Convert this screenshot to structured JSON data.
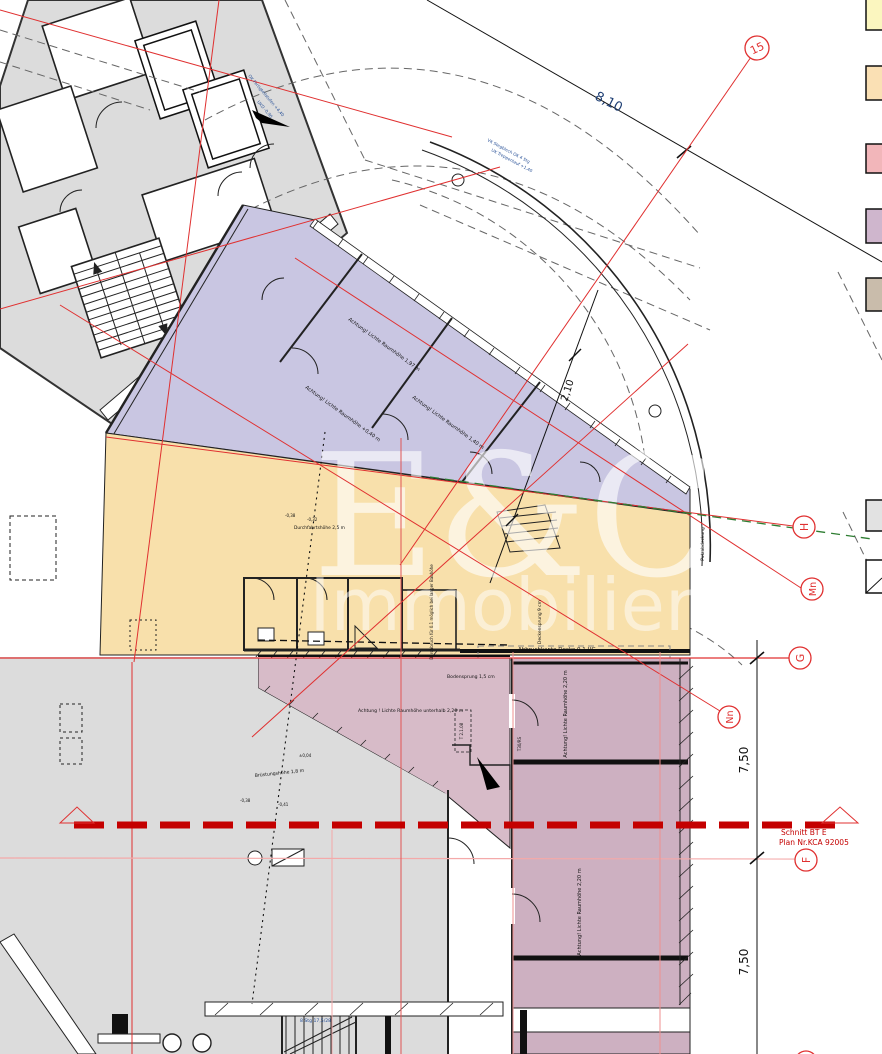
{
  "plan": {
    "watermark": {
      "line1": "E&C",
      "line2": "Immobilien"
    },
    "grid_bubbles": {
      "b15": "15",
      "h": "H",
      "mn": "Mn",
      "g": "G",
      "nn": "Nn",
      "f": "F"
    },
    "dimensions": {
      "d810": "8,10",
      "d210": "2,10",
      "d750a": "7,50",
      "d750b": "7,50"
    },
    "section_marker": {
      "line1": "Schnitt BT E",
      "line2": "Plan Nr.KCA 92005"
    },
    "annotations": {
      "abbruchkante": "Abbruchkante Decke 0.1 UG",
      "lichte_197": "Achtung! Lichte Raumhöhe 1,97 m",
      "lichte_040": "Achtung! Lichte Raumhöhe +0,40 m",
      "lichte_140": "Achtung! Lichte Raumhöhe 1,40 m",
      "lichte_220": "Achtung! Lichte Raumhöhe 2,20 m",
      "lichte_unterhalb": "Achtung ! Lichte Raumhöhe unterhalb 2,20 m",
      "bodensprung": "Bodensprung 1,5 cm",
      "deckensprung": "Deckensprung 9 cm",
      "durchbruch": "Durchbruch für 0.1 möglich bei langer Bauhöhe",
      "durchfahrt": "Durchfahrtshöhe 2,5 m",
      "bruestung": "Brüstungshöhe 1,8 m",
      "putzabdeckung": "Putzabdeckung",
      "treppe_stg": "8 Stg 17,5/28",
      "vk_stegblech": "VK Stegblech OK 4 Stg",
      "uk_treppenlauf": "UK Treppenlauf +1,40",
      "ok_fertigteil": "OK Fertigteilstufen +4,40",
      "ukd": "UKD -0,90",
      "t30rs": "T30/RS",
      "t2108": "T 2.1.08",
      "mark_038": "-0,38",
      "mark_032": "-0,32",
      "mark_041": "-0,41",
      "mark_004": "±0,04"
    },
    "colors": {
      "gray_area": "#dcdcdc",
      "lavender_area": "#c9c6e2",
      "yellow_area": "#f8e0ab",
      "rose_area": "#d7bbc8",
      "mauve_area": "#cdb0c1",
      "wall": "#2a2a2a",
      "red": "#e03030",
      "dark_red": "#c40000",
      "pink": "#f4a9a9",
      "light_red": "#ef8f8f",
      "green": "#2e7d32",
      "blue": "#2a5298",
      "watermark": "#ffffff"
    },
    "legend": {
      "swatches": [
        {
          "name": "legend-yellow",
          "color": "#fbf6bf"
        },
        {
          "name": "legend-orange",
          "color": "#fae0b4"
        },
        {
          "name": "legend-pink",
          "color": "#f2b6ba"
        },
        {
          "name": "legend-lilac",
          "color": "#cfb6cd"
        },
        {
          "name": "legend-tan",
          "color": "#c9bcab"
        },
        {
          "name": "legend-gray",
          "color": "#e2e2e2"
        },
        {
          "name": "legend-white",
          "color": "#ffffff"
        }
      ]
    }
  }
}
